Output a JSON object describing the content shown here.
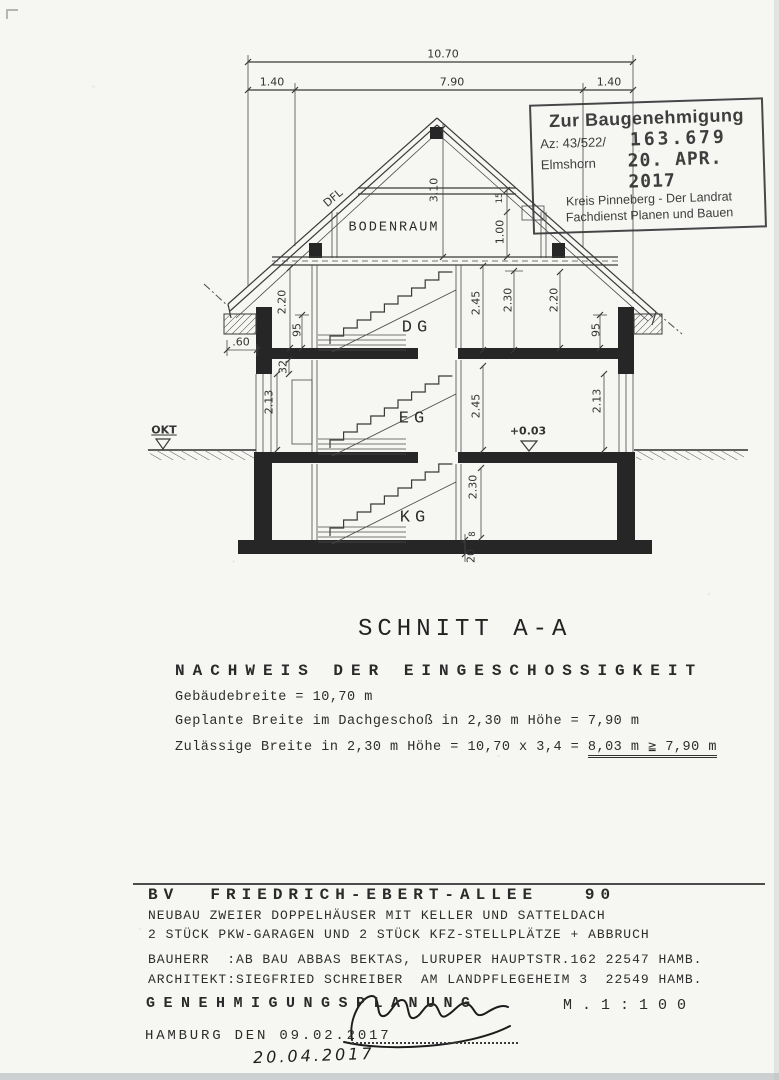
{
  "drawing": {
    "labels": [
      {
        "t": "10.70",
        "x": 443,
        "y": 54,
        "r": 0,
        "k": "dim"
      },
      {
        "t": "1.40",
        "x": 272,
        "y": 82,
        "r": 0,
        "k": "dim"
      },
      {
        "t": "7.90",
        "x": 452,
        "y": 82,
        "r": 0,
        "k": "dim"
      },
      {
        "t": "1.40",
        "x": 609,
        "y": 82,
        "r": 0,
        "k": "dim"
      },
      {
        "t": "DFL",
        "x": 333,
        "y": 198,
        "r": -40,
        "k": "dim"
      },
      {
        "t": "3.10",
        "x": 434,
        "y": 190,
        "r": -90,
        "k": "dim"
      },
      {
        "t": "1.00",
        "x": 500,
        "y": 232,
        "r": -90,
        "k": "dim"
      },
      {
        "t": "15",
        "x": 500,
        "y": 198,
        "r": -90,
        "k": "tiny"
      },
      {
        "t": "BODENRAUM",
        "x": 394,
        "y": 228,
        "r": 0,
        "k": "room-sm"
      },
      {
        "t": "2.20",
        "x": 282,
        "y": 302,
        "r": -90,
        "k": "dim"
      },
      {
        "t": "95",
        "x": 297,
        "y": 330,
        "r": -90,
        "k": "dim"
      },
      {
        "t": "32",
        "x": 283,
        "y": 367,
        "r": -90,
        "k": "dim"
      },
      {
        "t": "2.13",
        "x": 269,
        "y": 402,
        "r": -90,
        "k": "dim"
      },
      {
        "t": "DG",
        "x": 417,
        "y": 328,
        "r": 0,
        "k": "room"
      },
      {
        "t": "2.45",
        "x": 476,
        "y": 303,
        "r": -90,
        "k": "dim"
      },
      {
        "t": "2.30",
        "x": 508,
        "y": 300,
        "r": -90,
        "k": "dim"
      },
      {
        "t": "2.20",
        "x": 554,
        "y": 300,
        "r": -90,
        "k": "dim"
      },
      {
        "t": "95",
        "x": 596,
        "y": 330,
        "r": -90,
        "k": "dim"
      },
      {
        "t": ".60",
        "x": 241,
        "y": 342,
        "r": 0,
        "k": "dim"
      },
      {
        "t": "EG",
        "x": 414,
        "y": 419,
        "r": 0,
        "k": "room"
      },
      {
        "t": "2.45",
        "x": 476,
        "y": 406,
        "r": -90,
        "k": "dim"
      },
      {
        "t": "2.13",
        "x": 597,
        "y": 401,
        "r": -90,
        "k": "dim"
      },
      {
        "t": "+0.03",
        "x": 528,
        "y": 431,
        "r": 0,
        "k": "level"
      },
      {
        "t": "OKT",
        "x": 164,
        "y": 430,
        "r": 0,
        "k": "level okt"
      },
      {
        "t": "KG",
        "x": 415,
        "y": 518,
        "r": 0,
        "k": "room"
      },
      {
        "t": "2.30",
        "x": 473,
        "y": 487,
        "r": -90,
        "k": "dim"
      },
      {
        "t": "8",
        "x": 473,
        "y": 534,
        "r": -90,
        "k": "tiny"
      },
      {
        "t": "20",
        "x": 471,
        "y": 556,
        "r": -90,
        "k": "dim"
      }
    ]
  },
  "stamp": {
    "title": "Zur Baugenehmigung",
    "az_label": "Az: 43/522/",
    "az_number": "163.679",
    "place": "Elmshorn",
    "date": "20. APR. 2017",
    "authority_line1": "Kreis Pinneberg - Der Landrat",
    "authority_line2": "Fachdienst Planen und Bauen"
  },
  "section": {
    "title": "SCHNITT A-A",
    "proof_heading": "NACHWEIS DER EINGESCHOSSIGKEIT",
    "line1": "Gebäudebreite = 10,70 m",
    "line2": "Geplante Breite im Dachgeschoß in 2,30 m Höhe = 7,90 m",
    "line3_prefix": "Zulässige Breite in 2,30 m Höhe = 10,70 x 3,4 = ",
    "line3_result": "8,03 m ≧ 7,90 m"
  },
  "footer": {
    "project_title": "BV  FRIEDRICH-EBERT-ALLEE   90",
    "project_line1": "NEUBAU ZWEIER DOPPELHÄUSER MIT KELLER UND SATTELDACH",
    "project_line2": "2 STÜCK PKW-GARAGEN UND 2 STÜCK KFZ-STELLPLÄTZE + ABBRUCH",
    "bauherr": "BAUHERR  :AB BAU ABBAS BEKTAS, LURUPER HAUPTSTR.162 22547 HAMB.",
    "architekt": "ARCHITEKT:SIEGFRIED SCHREIBER  AM LANDPFLEGEHEIM 3  22549 HAMB.",
    "planning_type": "GENEHMIGUNGSPLANUNG",
    "scale": "M.1:100",
    "city_date": "HAMBURG DEN 09.02.2017",
    "handwritten_date": "20.04.2017"
  }
}
